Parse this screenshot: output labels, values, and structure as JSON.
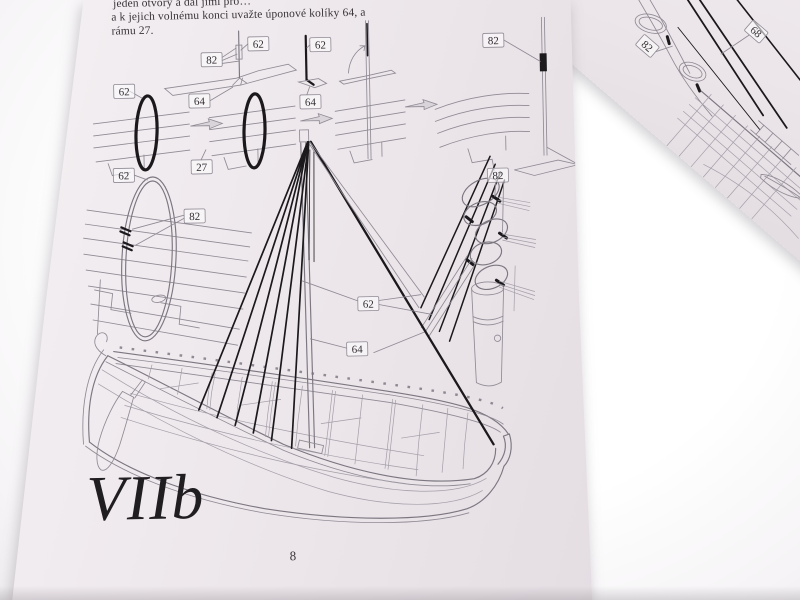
{
  "doc": {
    "top_text": {
      "cut_line": "jeden otvory a dál jimi pro…",
      "line1": "a k jejich volnému konci uvažte úponové kolíky 64, a",
      "line2": "rámu 27."
    },
    "figure_label": "VIIb",
    "page_number": "8",
    "callouts": {
      "a62": "62",
      "b82": "82",
      "c64": "64",
      "d62": "62",
      "e64": "64",
      "f82": "82",
      "g62": "62",
      "h27": "27",
      "i62": "62",
      "j82": "82",
      "k82": "82",
      "l62": "62",
      "m64": "64"
    },
    "overlay": {
      "c82": "82",
      "c68": "68"
    }
  },
  "colors": {
    "paper": "#ece6ea",
    "backdrop": "#ffffff",
    "line_art": "#8f8a94",
    "ink": "#1b191c"
  }
}
